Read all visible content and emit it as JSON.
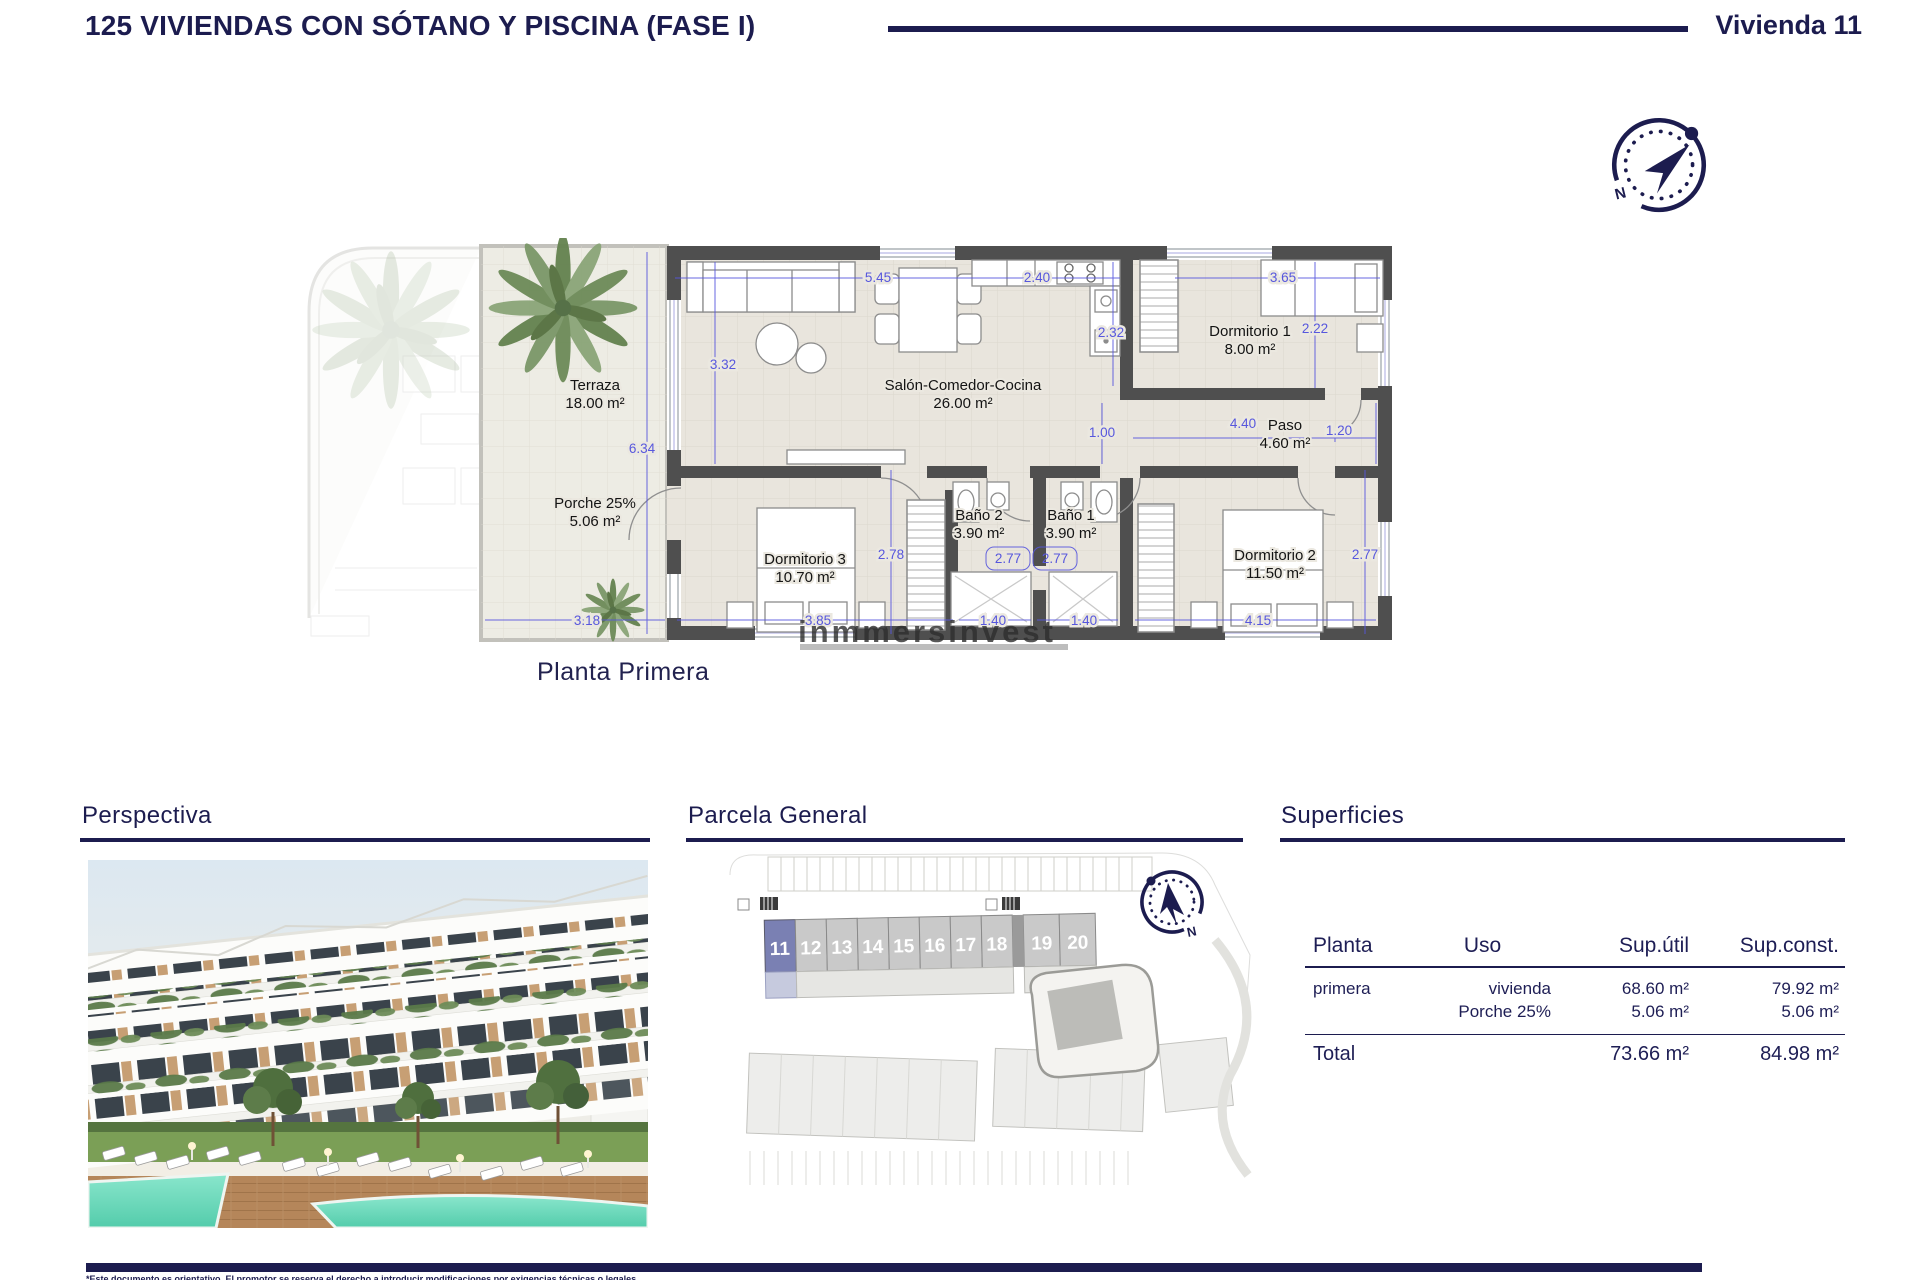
{
  "header": {
    "title": "125 VIVIENDAS CON SÓTANO Y PISCINA (FASE I)",
    "unit": "Vivienda 11"
  },
  "floorplan": {
    "caption": "Planta Primera",
    "watermark": "inmmersinvest",
    "rooms": [
      {
        "name": "Terraza",
        "area": "18.00 m²"
      },
      {
        "name": "Porche 25%",
        "area": "5.06 m²"
      },
      {
        "name": "Salón-Comedor-Cocina",
        "area": "26.00 m²"
      },
      {
        "name": "Dormitorio 1",
        "area": "8.00 m²"
      },
      {
        "name": "Paso",
        "area": "4.60 m²"
      },
      {
        "name": "Baño 2",
        "area": "3.90 m²"
      },
      {
        "name": "Baño 1",
        "area": "3.90 m²"
      },
      {
        "name": "Dormitorio 3",
        "area": "10.70 m²"
      },
      {
        "name": "Dormitorio 2",
        "area": "11.50 m²"
      }
    ],
    "dimensions": [
      "5.45",
      "2.40",
      "3.65",
      "3.32",
      "2.32",
      "2.22",
      "6.34",
      "1.00",
      "4.40",
      "1.20",
      "2.78",
      "2.77",
      "2.77",
      "2.77",
      "3.18",
      "3.85",
      "1.40",
      "1.40",
      "4.15"
    ]
  },
  "sections": {
    "perspectiva": "Perspectiva",
    "parcela": "Parcela General",
    "superficies": "Superficies"
  },
  "parcela": {
    "units": [
      "11",
      "12",
      "13",
      "14",
      "15",
      "16",
      "17",
      "18",
      "19",
      "20"
    ],
    "highlighted_unit": "11"
  },
  "superficies": {
    "headers": [
      "Planta",
      "Uso",
      "Sup.útil",
      "Sup.const."
    ],
    "rows": [
      {
        "planta": "primera",
        "uso": "vivienda",
        "sup_util": "68.60 m²",
        "sup_const": "79.92 m²"
      },
      {
        "planta": "",
        "uso": "Porche 25%",
        "sup_util": "5.06 m²",
        "sup_const": "5.06 m²"
      }
    ],
    "total": {
      "label": "Total",
      "sup_util": "73.66 m²",
      "sup_const": "84.98 m²"
    }
  },
  "compass": {
    "north_label": "N"
  },
  "footer": {
    "disclaimer": "*Este documento es orientativo. El promotor se reserva el derecho a introducir modificaciones por exigencias técnicas o legales."
  },
  "colors": {
    "navy": "#1c1c4f",
    "dim_blue": "#5757dd",
    "wall_gray": "#4f4f4f",
    "unit_highlight": "#7a80b3"
  }
}
